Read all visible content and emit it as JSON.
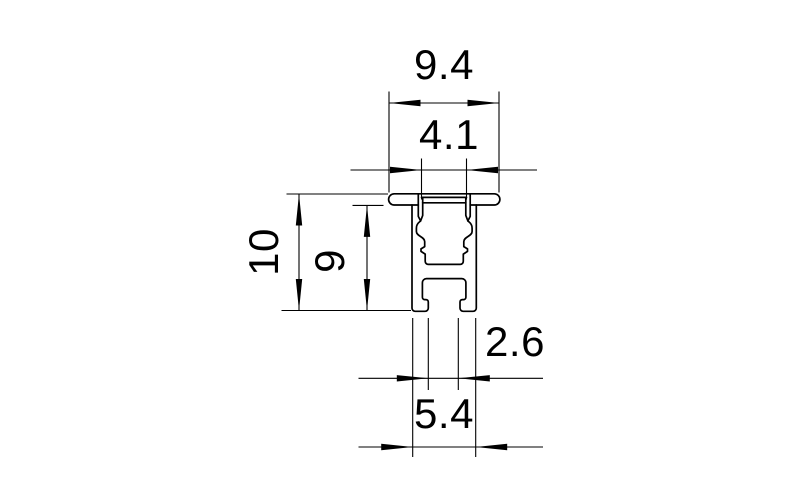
{
  "drawing": {
    "colors": {
      "line": "#000000",
      "background": "#ffffff"
    },
    "dimension_labels": {
      "cap_width": "9.4",
      "top_recess_width": "4.1",
      "overall_height": "10",
      "body_height": "9",
      "groove_opening_width": "2.6",
      "base_width": "5.4"
    }
  }
}
